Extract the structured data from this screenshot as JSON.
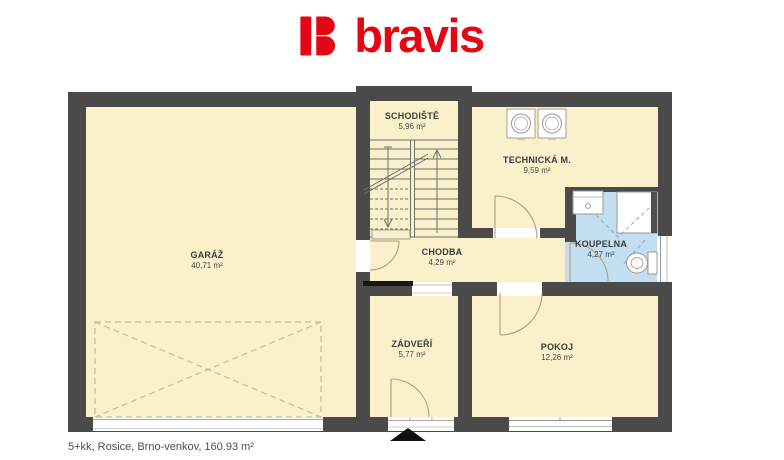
{
  "logo": {
    "brand": "bravis"
  },
  "plan": {
    "rooms": [
      {
        "id": "garaz",
        "name": "GARÁŽ",
        "area": "40,71 m²"
      },
      {
        "id": "schodiste",
        "name": "SCHODIŠTĚ",
        "area": "5,96 m²"
      },
      {
        "id": "technicka",
        "name": "TECHNICKÁ M.",
        "area": "9,59 m²"
      },
      {
        "id": "chodba",
        "name": "CHODBA",
        "area": "4,29 m²"
      },
      {
        "id": "koupelna",
        "name": "KOUPELNA",
        "area": "4,27 m²"
      },
      {
        "id": "zadveri",
        "name": "ZÁDVEŘÍ",
        "area": "5,77 m²"
      },
      {
        "id": "pokoj",
        "name": "POKOJ",
        "area": "12,26 m²"
      }
    ],
    "colors": {
      "wall": "#4a4a4a",
      "floor": "#faf0ca",
      "bathroom_floor": "#c3ddf1",
      "brand_red": "#e30613"
    }
  },
  "footer": {
    "caption": "5+kk, Rosice, Brno-venkov, 160.93 m²"
  }
}
